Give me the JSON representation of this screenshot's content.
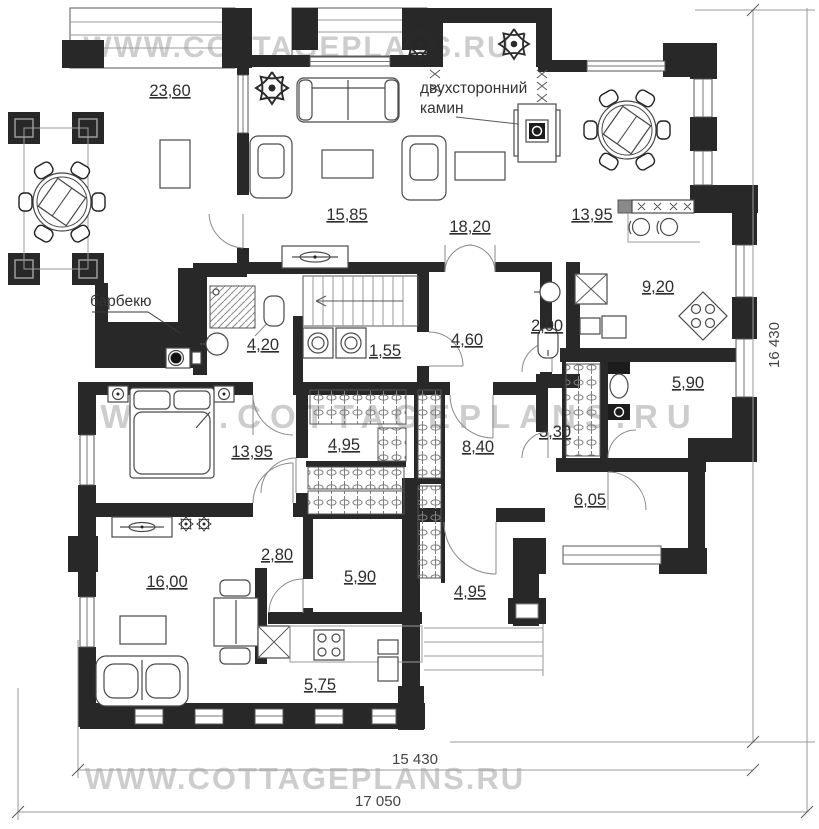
{
  "watermark": {
    "text": "WWW.COTTAGEPLANS.RU"
  },
  "annotations": {
    "fireplace_line1": "двухсторонний",
    "fireplace_line2": "камин",
    "barbecue": "барбекю"
  },
  "rooms": {
    "terrace": "23,60",
    "living": "15,85",
    "family": "18,20",
    "dining": "13,95",
    "kitchen": "9,20",
    "bathroom1": "4,20",
    "laundry": "1,55",
    "hall": "4,60",
    "wc": "2,00",
    "bathroom2": "5,90",
    "bedroom": "13,95",
    "wardrobe1": "4,95",
    "corridor": "8,40",
    "wardrobe2": "3,30",
    "room605": "6,05",
    "hallway": "2,80",
    "lounge": "16,00",
    "room590": "5,90",
    "porch": "4,95",
    "kitchen2": "5,75"
  },
  "dimensions": {
    "height": "16 430",
    "width_inner": "15 430",
    "width_outer": "17 050"
  },
  "colors": {
    "wall": "#282828",
    "watermark": "#b0b0b0",
    "label": "#2e2e2e"
  }
}
